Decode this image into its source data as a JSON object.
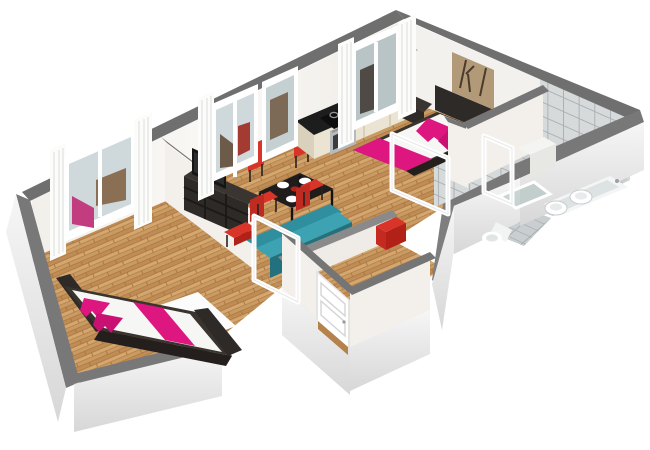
{
  "scene": {
    "type": "3d-floorplan-render",
    "description": "Isometric cutaway 3D floor plan of a two-bedroom apartment on a white background",
    "background": "#ffffff"
  },
  "palette": {
    "wallTop": "#6f6f6f",
    "wallTopLight": "#7e7e7e",
    "wallInner": "#f7f5f2",
    "wallInnerShade": "#eceae5",
    "wallOuter": "#ededed",
    "wood": "#c99a62",
    "woodDark": "#b5824c",
    "woodLight": "#d9ac72",
    "tileWall": "#d6dadb",
    "tileFloor": "#c9ced0",
    "grout": "#aab0b2",
    "glass": "#cfd9db",
    "glassTint": "#aabfb9",
    "pink": "#de1680",
    "pinkDeep": "#b80f69",
    "teal": "#2f8f9f",
    "tealLight": "#3da2b1",
    "tealDark": "#23707e",
    "red": "#d8342a",
    "redDark": "#b22117",
    "darkFurniture": "#2e2a27",
    "darkFurnitureLight": "#45403b",
    "black": "#161414",
    "cream": "#ebe4d2",
    "creamShade": "#d9d1bc",
    "steel": "#b7babc",
    "steelDark": "#90999c",
    "white": "#ffffff",
    "artTan": "#b29a78",
    "artDark": "#4a3b2a"
  },
  "rooms": [
    {
      "id": "bedroom-1",
      "floor": "wood",
      "objects": [
        "double-bed-dark-frame",
        "pink-duvet-runner",
        "pink-pillows",
        "white-rug",
        "window-with-white-curtains"
      ]
    },
    {
      "id": "living-dining",
      "floor": "wood",
      "objects": [
        "tv",
        "tv-shelf-unit",
        "black-dining-table",
        "4-red-chairs",
        "white-plates",
        "teal-sofa",
        "red-bench",
        "window",
        "glass-door"
      ]
    },
    {
      "id": "kitchen",
      "floor": "wood",
      "objects": [
        "cream-cabinets",
        "black-countertop",
        "oven",
        "cooktop-4-burners",
        "steel-sink"
      ]
    },
    {
      "id": "bedroom-2",
      "floor": "wood",
      "objects": [
        "double-bed-dark-frame",
        "pink-pillows",
        "pink-foot-runner",
        "2-nightstands",
        "wall-art",
        "window-with-white-curtains",
        "open-door",
        "red-stool"
      ]
    },
    {
      "id": "bathroom",
      "floor": "tile",
      "objects": [
        "bathtub",
        "2-sinks",
        "glass-shower",
        "white-cabinet",
        "tiled-walls",
        "open-door"
      ]
    },
    {
      "id": "wc",
      "floor": "tile",
      "objects": [
        "toilet",
        "tiled-walls"
      ]
    },
    {
      "id": "hallway",
      "floor": "wood",
      "objects": [
        "entry-door-white"
      ]
    }
  ]
}
